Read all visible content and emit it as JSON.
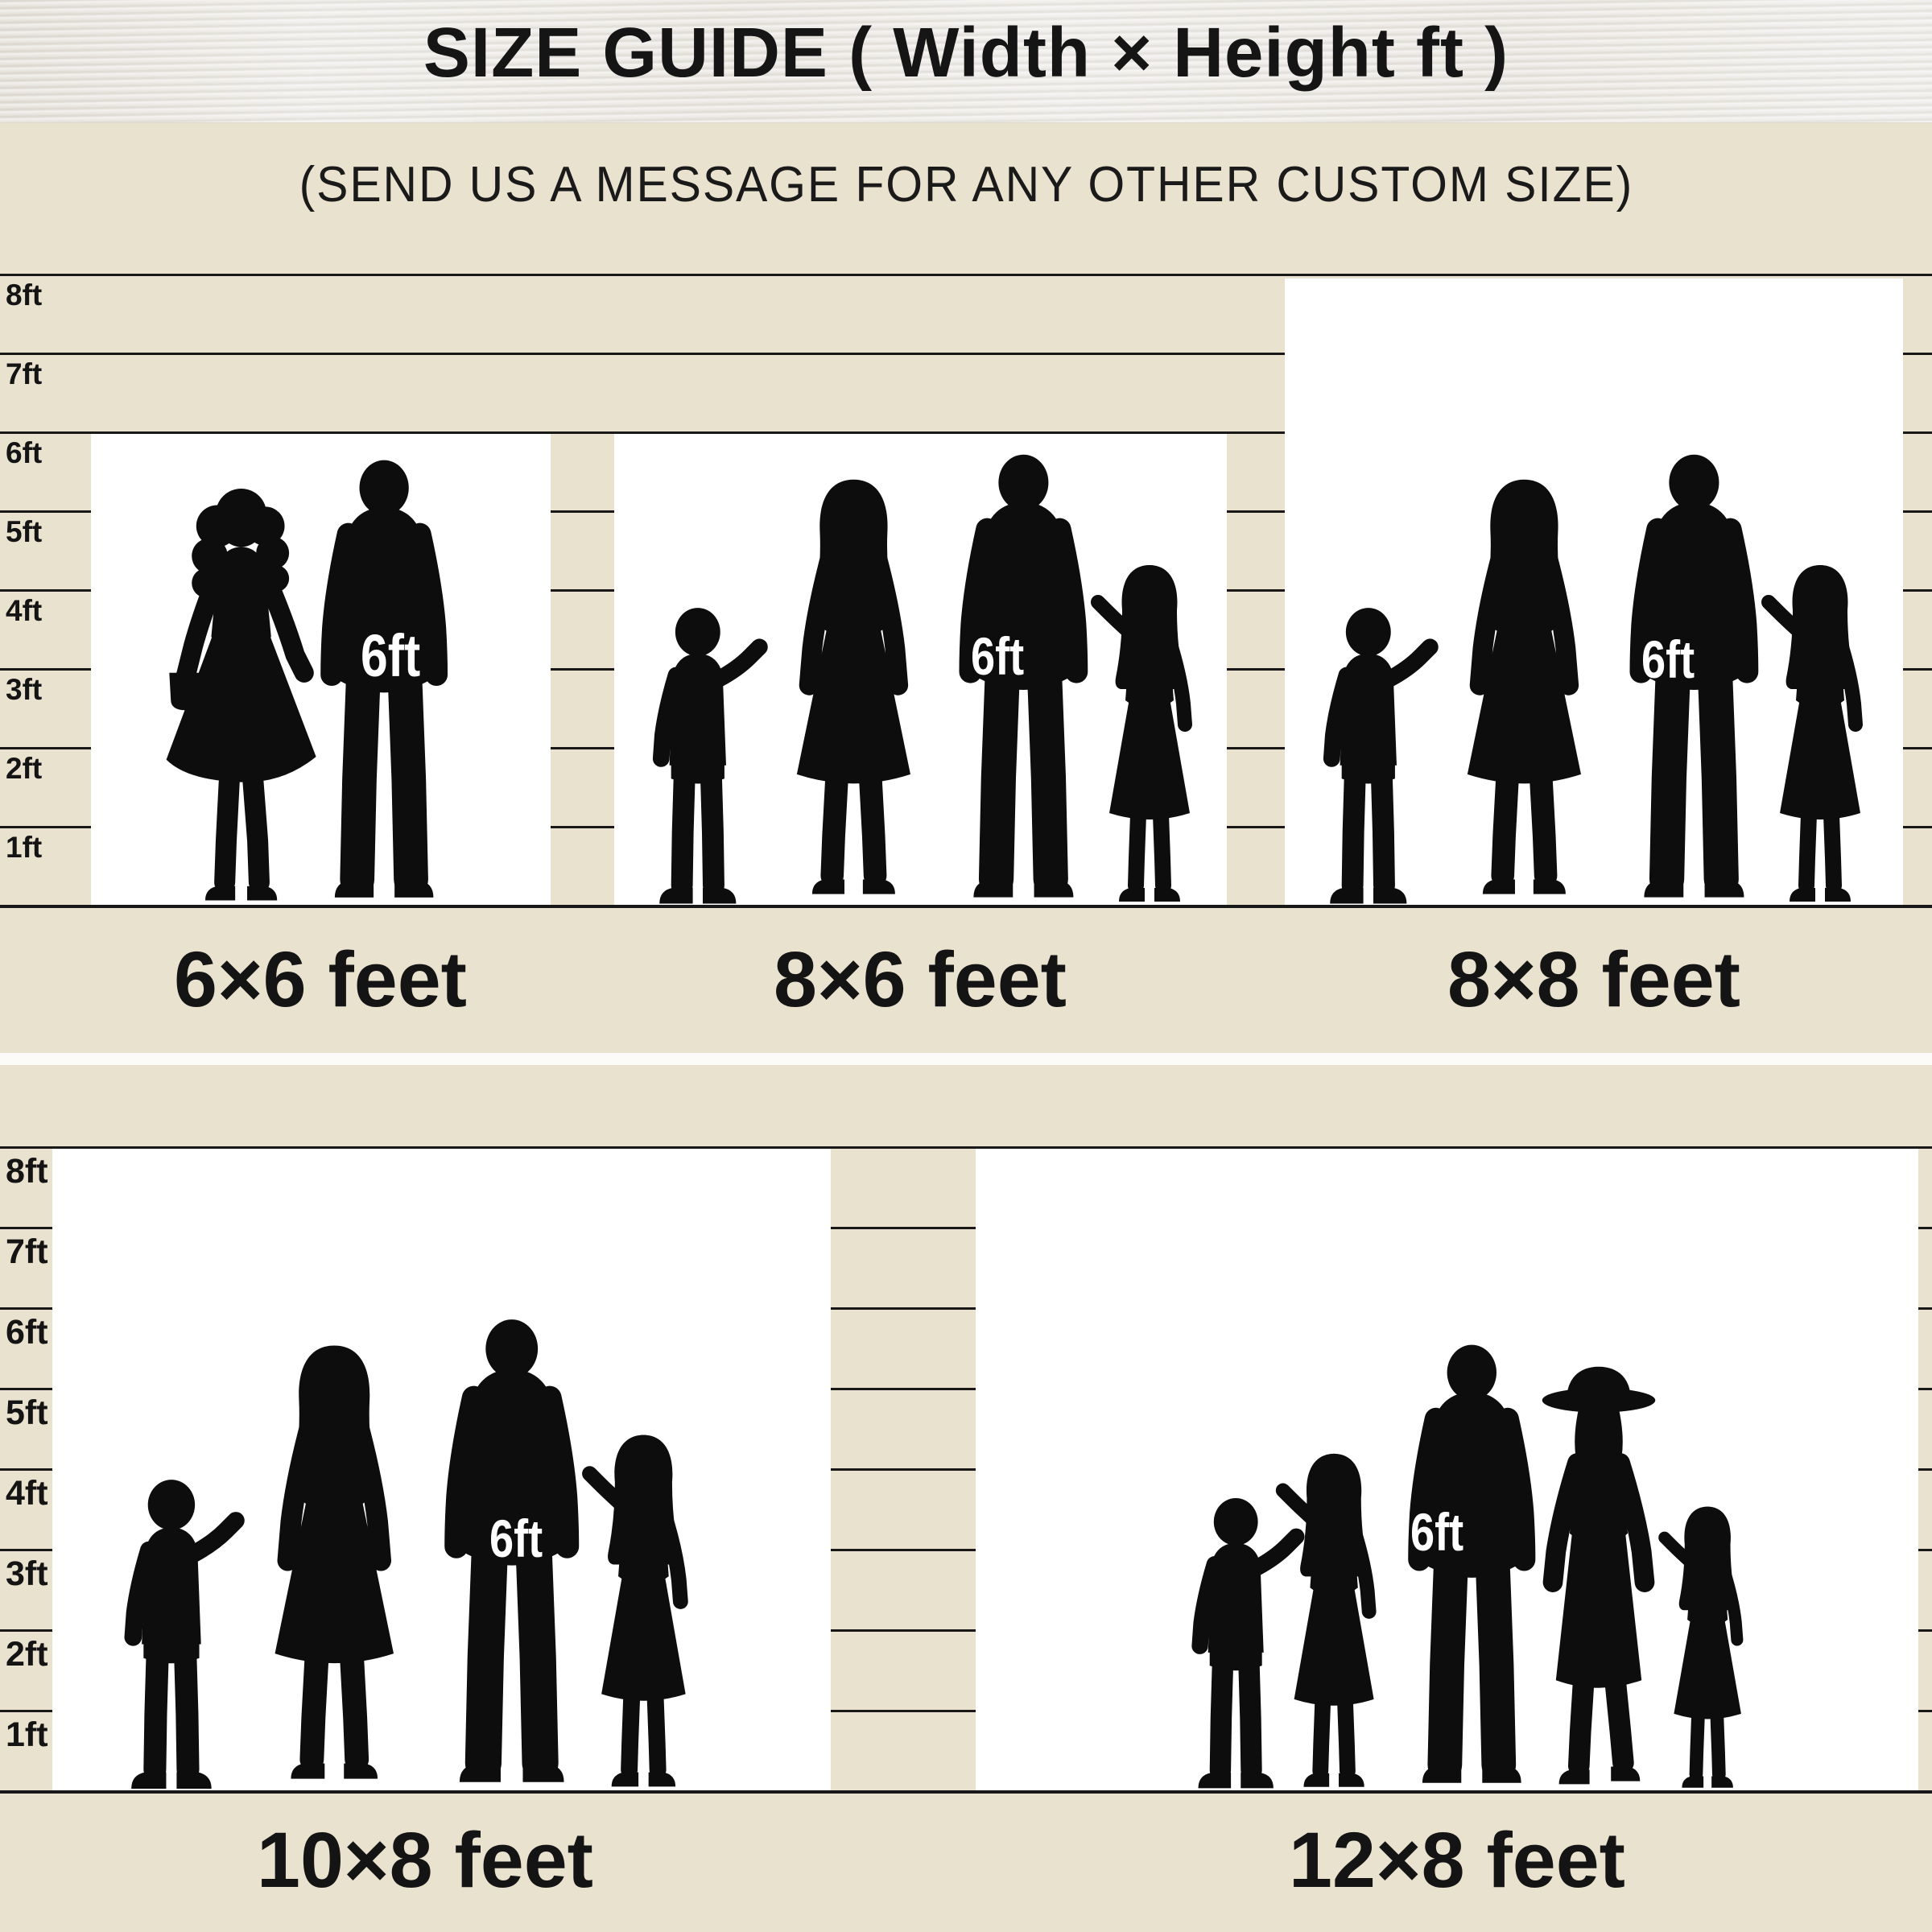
{
  "header": {
    "title": "SIZE GUIDE ( Width × Height ft )",
    "subtitle": "(SEND US A MESSAGE FOR ANY OTHER CUSTOM SIZE)"
  },
  "colors": {
    "background": "#e9e2cf",
    "wood_header": "#edebe7",
    "ink": "#141414",
    "box_fill": "#ffffff",
    "silhouette": "#0d0d0d",
    "divider_band": "#fcfbf7",
    "marker_text": "#ffffff"
  },
  "section_top": {
    "ruler_labels": [
      "8ft",
      "7ft",
      "6ft",
      "5ft",
      "4ft",
      "3ft",
      "2ft",
      "1ft"
    ],
    "boxes": [
      {
        "size_label": "6×6 feet",
        "person_height": "6ft",
        "people_count": 2
      },
      {
        "size_label": "8×6 feet",
        "person_height": "6ft",
        "people_count": 4
      },
      {
        "size_label": "8×8 feet",
        "person_height": "6ft",
        "people_count": 4
      }
    ]
  },
  "section_bottom": {
    "ruler_labels": [
      "8ft",
      "7ft",
      "6ft",
      "5ft",
      "4ft",
      "3ft",
      "2ft",
      "1ft"
    ],
    "boxes": [
      {
        "size_label": "10×8 feet",
        "person_height": "6ft",
        "people_count": 4
      },
      {
        "size_label": "12×8 feet",
        "person_height": "6ft",
        "people_count": 5
      }
    ]
  }
}
